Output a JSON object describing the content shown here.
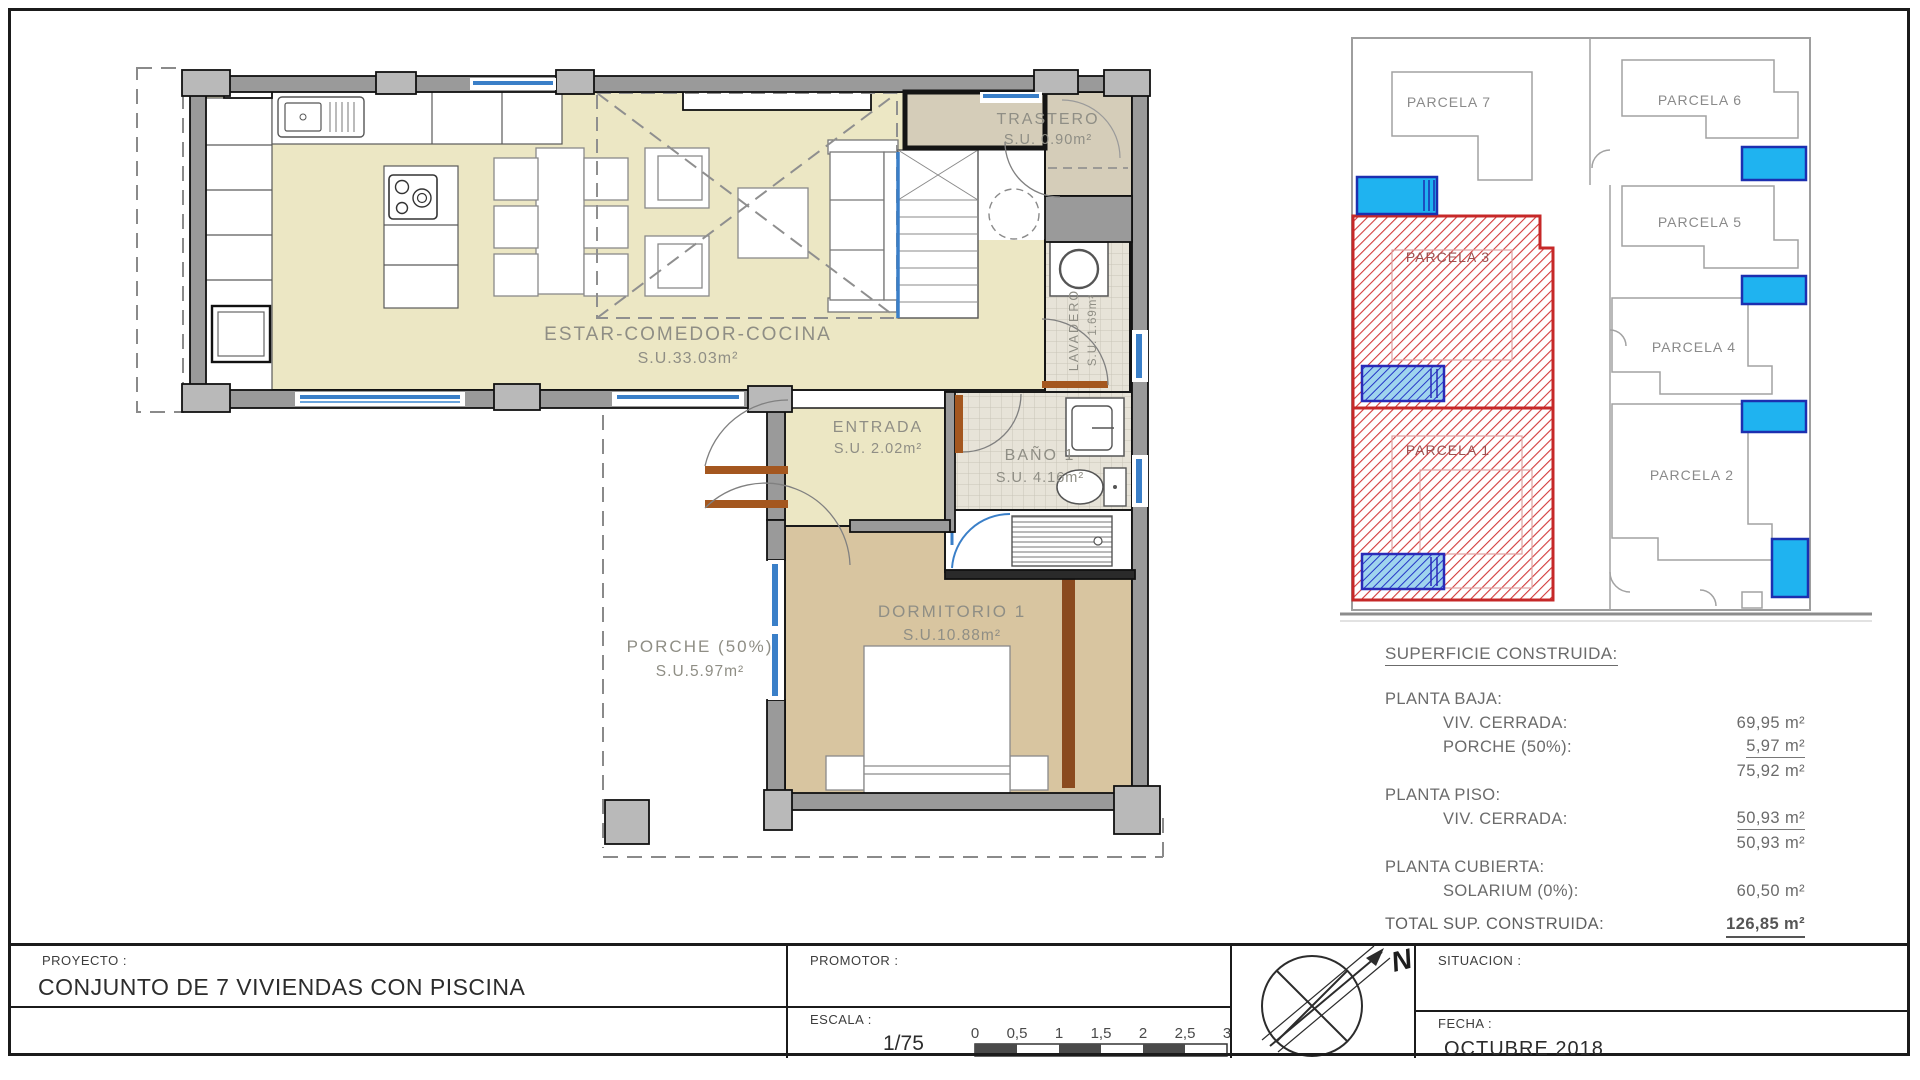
{
  "colors": {
    "floor_living": "#ece7c4",
    "floor_bedroom": "#d8c5a0",
    "floor_storage": "#d5cdb9",
    "wall_fill": "#9a9a9a",
    "pillar_fill": "#b9b9b9",
    "window_blue": "#3a7fc8",
    "door_brown": "#a4571f",
    "parcel_red": "#c62828",
    "pool_cyan": "#1fb3f0",
    "pool_dark_blue": "#1c2fb0"
  },
  "floorplan": {
    "estar": {
      "name": "ESTAR-COMEDOR-COCINA",
      "area": "S.U.33.03m²"
    },
    "trastero": {
      "name": "TRASTERO",
      "area": "S.U. 0.90m²"
    },
    "lavadero": {
      "name": "LAVADERO",
      "area": "S.U. 1.69m²"
    },
    "entrada": {
      "name": "ENTRADA",
      "area": "S.U. 2.02m²"
    },
    "bano": {
      "name": "BAÑO 1",
      "area": "S.U. 4.16m²"
    },
    "dormitorio": {
      "name": "DORMITORIO 1",
      "area": "S.U.10.88m²"
    },
    "porche": {
      "name": "PORCHE (50%)",
      "area": "S.U.5.97m²"
    }
  },
  "siteplan": {
    "p1": "PARCELA 1",
    "p2": "PARCELA 2",
    "p3": "PARCELA 3",
    "p4": "PARCELA 4",
    "p5": "PARCELA 5",
    "p6": "PARCELA 6",
    "p7": "PARCELA 7"
  },
  "surface": {
    "heading": "SUPERFICIE CONSTRUIDA:",
    "g1_title": "PLANTA BAJA:",
    "g1_r1_label": "VIV. CERRADA:",
    "g1_r1_value": "69,95 m²",
    "g1_r2_label": "PORCHE (50%):",
    "g1_r2_value": "5,97 m²",
    "g1_subtotal": "75,92 m²",
    "g2_title": "PLANTA PISO:",
    "g2_r1_label": "VIV. CERRADA:",
    "g2_r1_value": "50,93 m²",
    "g2_subtotal": "50,93 m²",
    "g3_title": "PLANTA CUBIERTA:",
    "g3_r1_label": "SOLARIUM (0%):",
    "g3_r1_value": "60,50 m²",
    "total_label": "TOTAL SUP. CONSTRUIDA:",
    "total_value": "126,85 m²"
  },
  "titleblock": {
    "proyecto_label": "PROYECTO :",
    "proyecto_value": "CONJUNTO DE 7 VIVIENDAS CON PISCINA",
    "promotor_label": "PROMOTOR :",
    "escala_label": "ESCALA :",
    "escala_value": "1/75",
    "situacion_label": "SITUACION :",
    "fecha_label": "FECHA :",
    "fecha_value": "OCTUBRE 2018",
    "north": "N",
    "scale_ticks": [
      "0",
      "0,5",
      "1",
      "1,5",
      "2",
      "2,5",
      "3"
    ]
  }
}
